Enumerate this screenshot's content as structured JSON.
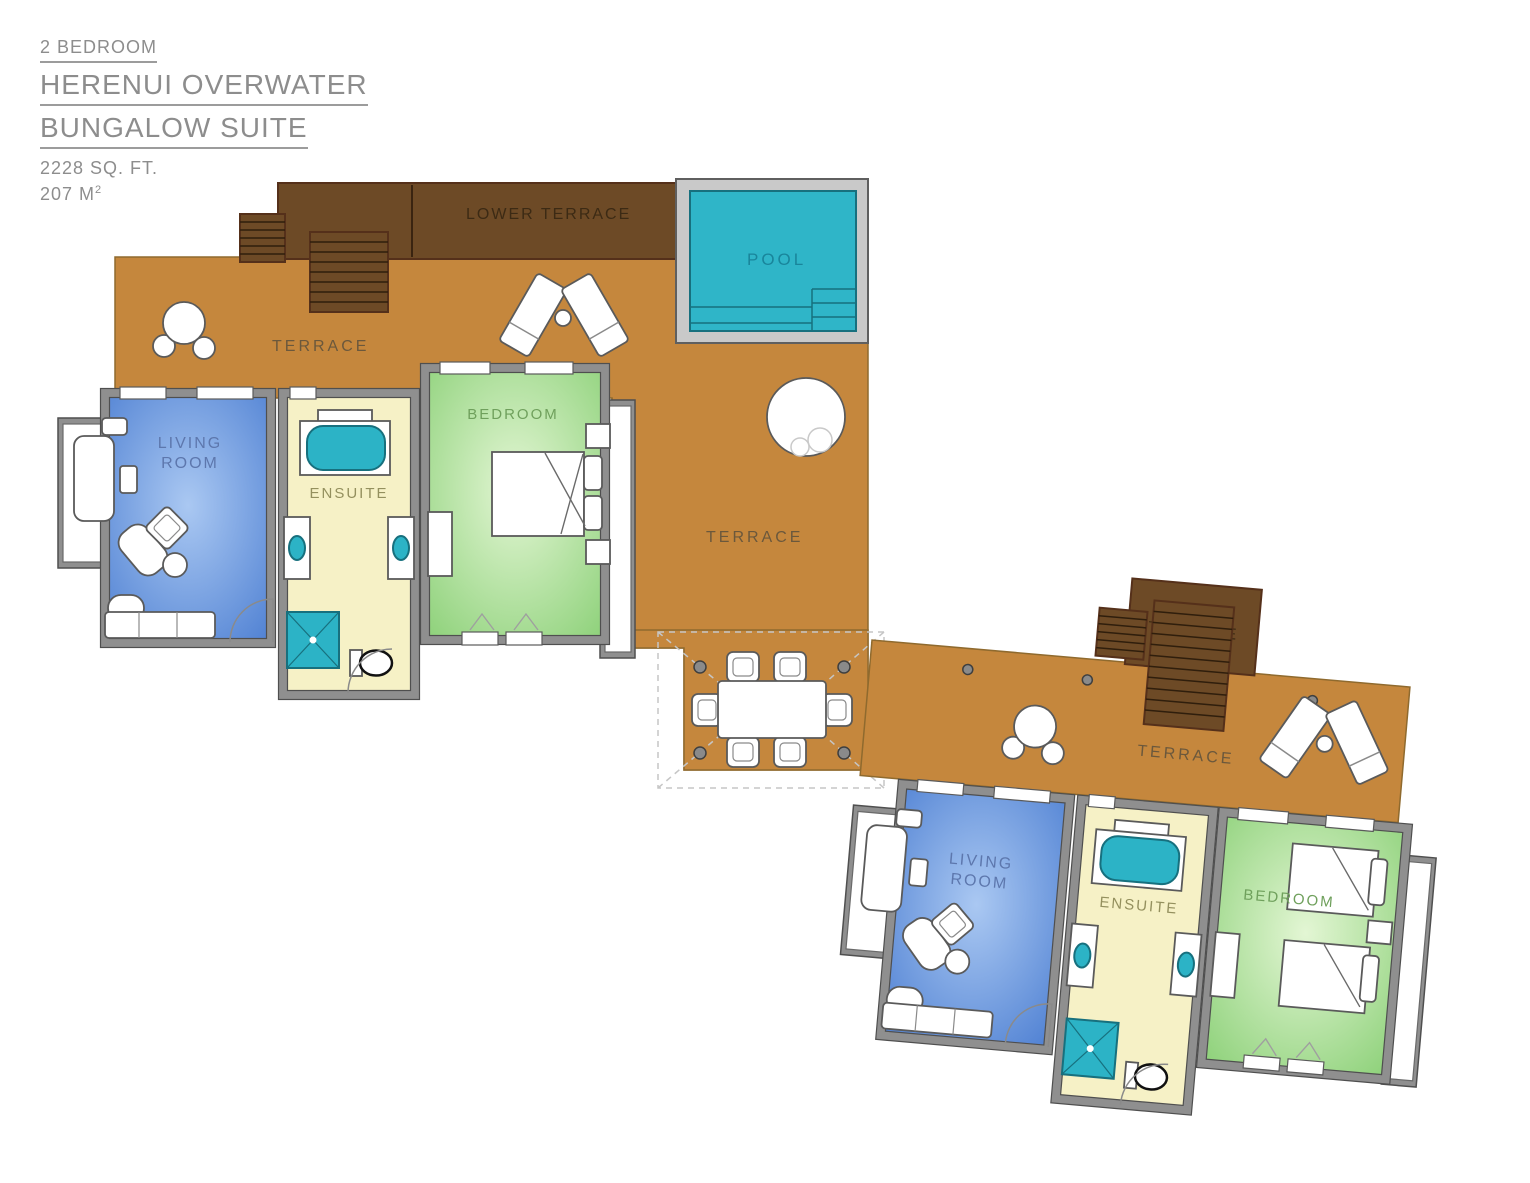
{
  "title_block": {
    "category": "2 BEDROOM",
    "name_line1": "HERENUI OVERWATER",
    "name_line2": "BUNGALOW SUITE",
    "area_sqft": "2228 SQ. FT.",
    "area_m": "207 M",
    "area_m_sup": "2"
  },
  "upper_unit": {
    "lower_terrace_label": "LOWER TERRACE",
    "terrace_label_left": "TERRACE",
    "terrace_label_main": "TERRACE",
    "pool_label": "POOL",
    "living_room_label_line1": "LIVING",
    "living_room_label_line2": "ROOM",
    "ensuite_label": "ENSUITE",
    "bedroom_label": "BEDROOM"
  },
  "lower_unit": {
    "lower_terrace_label_line1": "LOWER",
    "lower_terrace_label_line2": "TERRACE",
    "terrace_label": "TERRACE",
    "living_room_label_line1": "LIVING",
    "living_room_label_line2": "ROOM",
    "ensuite_label": "ENSUITE",
    "bedroom_label": "BEDROOM"
  },
  "palette": {
    "title_text": "#8d8d8d",
    "title_underline": "#9c9c9c",
    "terrace": "#c5873d",
    "terrace_edge": "#8f6a2e",
    "terrace_text": "#6b583c",
    "lower_terrace": "#6d4a26",
    "lower_terrace_edge": "#55301a",
    "lower_terrace_text": "#3c2a14",
    "tread": "#2f1e0c",
    "pool": "#2fb5c8",
    "pool_frame": "#c9c9c9",
    "pool_text": "#19859b",
    "teal_dark": "#17707e",
    "fixture_teal": "#2cb3c6",
    "wall": "#8f8f8f",
    "wall_dark": "#4f4f4f",
    "furn_stroke": "#5a5a5a",
    "living_edge": "#4d7fd2",
    "living_center": "#aac8f2",
    "living_text": "#5d77ad",
    "ensuite_fill": "#f6f1c6",
    "ensuite_text": "#94905e",
    "bedroom_edge": "#8bd077",
    "bedroom_center": "#e3f6d4",
    "bedroom_text": "#6fa05c"
  }
}
